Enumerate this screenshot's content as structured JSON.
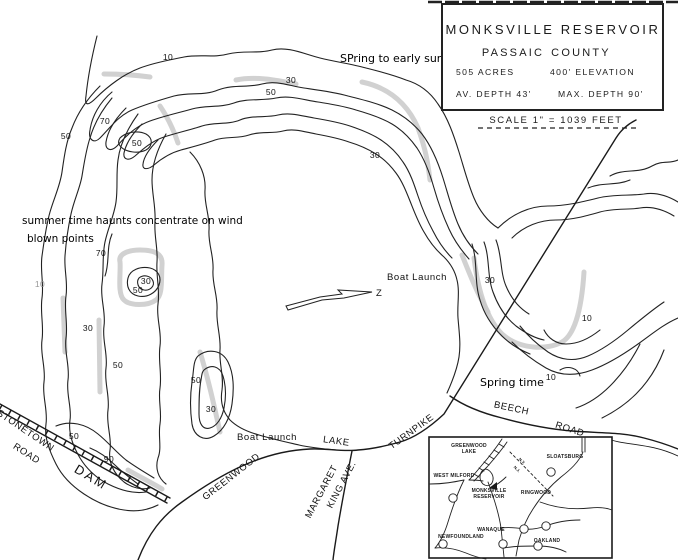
{
  "colors": {
    "ink": "#222222",
    "annotation": "#000000",
    "highlight": "#c9c9c9",
    "paper": "#ffffff"
  },
  "title_box": {
    "title": "MONKSVILLE RESERVOIR",
    "county_left": "PASSAIC",
    "county_right": "COUNTY",
    "acres": "505 ACRES",
    "elevation": "400' ELEVATION",
    "avg_depth": "AV. DEPTH 43'",
    "max_depth": "MAX. DEPTH 90'",
    "scale": "SCALE 1\" = 1039 FEET"
  },
  "annotations": {
    "spring_early_summer": "SPring to early summer",
    "summer_haunts_line1": "summer time haunts concentrate on wind",
    "summer_haunts_line2": "blown points",
    "spring_time": "Spring time"
  },
  "map_labels": {
    "boat_launch_main": "Boat Launch",
    "boat_launch_south": "Boat Launch",
    "north_arrow": "Z"
  },
  "roads": {
    "stonetown": "STONETOWN",
    "stonetown_road": "ROAD",
    "dam": "DAM",
    "greenwood": "GREENWOOD",
    "lake": "LAKE",
    "turnpike": "TURNPIKE",
    "margaret": "MARGARET",
    "king_ave": "KING AVE.",
    "beech": "BEECH",
    "beech_road": "ROAD"
  },
  "depth_labels": [
    "10",
    "30",
    "50",
    "70",
    "50",
    "50",
    "30",
    "70",
    "10",
    "30",
    "50",
    "30",
    "50",
    "50",
    "30",
    "50",
    "90",
    "30",
    "10",
    "10"
  ],
  "inset": {
    "greenwood_line1": "GREENWOOD",
    "greenwood_line2": "LAKE",
    "sloatsburg": "SLOATSBURG",
    "west_milford": "WEST MILFORD",
    "monksville_line1": "MONKSVILLE",
    "monksville_line2": "RESERVOIR",
    "ringwood": "RINGWOOD",
    "wanaque": "WANAQUE",
    "newfoundland": "NEWFOUNDLAND",
    "oakland": "OAKLAND",
    "state_line_ny": "N.Y.",
    "state_line_nj": "N.J."
  }
}
